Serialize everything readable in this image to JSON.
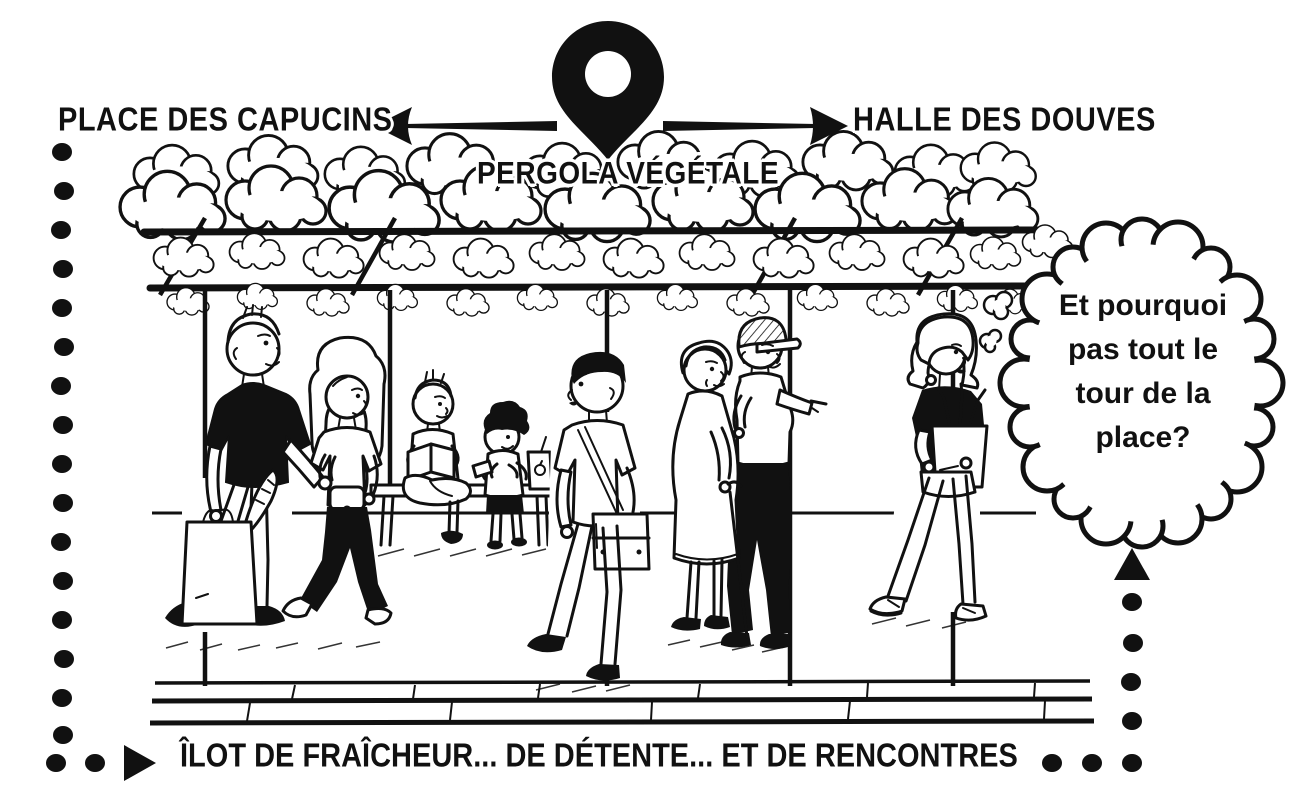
{
  "colors": {
    "background": "#ffffff",
    "ink": "#111111"
  },
  "header": {
    "left_destination": "PLACE DES CAPUCINS",
    "right_destination": "HALLE DES DOUVES",
    "location_label": "PERGOLA VÉGÉTALE"
  },
  "thought_bubble": {
    "full_text": "Et pourquoi pas tout le tour de la place?",
    "line1": "Et pourquoi",
    "line2": "pas tout le",
    "line3": "tour de la",
    "line4": "place?"
  },
  "caption": {
    "text": "ÎLOT DE FRAÎCHEUR... DE DÉTENTE... ET DE RENCONTRES"
  },
  "icons": {
    "pin": "map-pin-icon",
    "arrow_left": "arrow-left-icon",
    "arrow_right": "arrow-right-icon",
    "caption_marker": "triangle-right-icon",
    "route_pointer": "triangle-up-icon"
  },
  "scene": {
    "elements": [
      "vegetated-pergola",
      "pergola-posts",
      "public-bench",
      "paved-walkway",
      "dotted-route-border"
    ],
    "people": [
      "man-with-tote-bag",
      "woman-holding-hands",
      "teen-reading-on-bench",
      "child-with-snack-and-juice-box",
      "man-with-messenger-bag",
      "elderly-woman-with-cane",
      "man-with-cap-pointing",
      "woman-with-grocery-bag-thinking"
    ]
  }
}
